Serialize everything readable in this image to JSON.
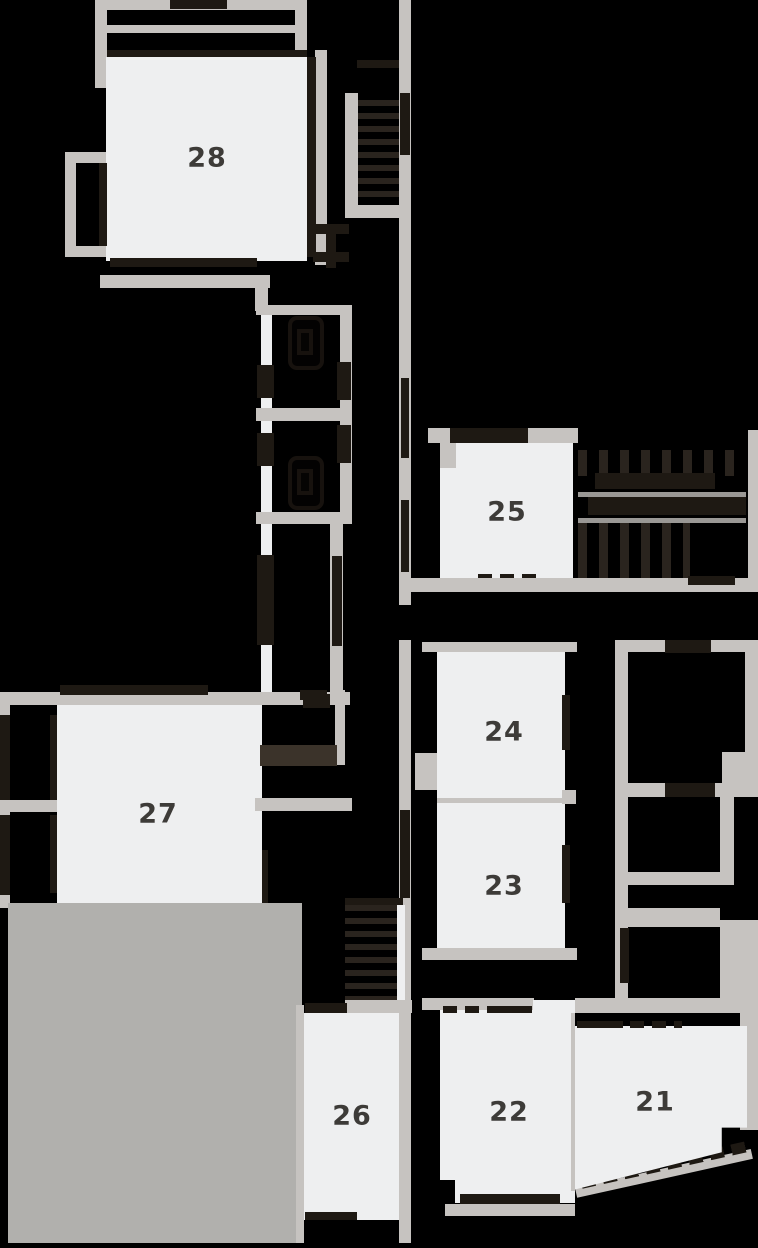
{
  "floor_plan": {
    "units": {
      "u21": {
        "label": "21"
      },
      "u22": {
        "label": "22"
      },
      "u23": {
        "label": "23"
      },
      "u24": {
        "label": "24"
      },
      "u25": {
        "label": "25"
      },
      "u26": {
        "label": "26"
      },
      "u27": {
        "label": "27"
      },
      "u28": {
        "label": "28"
      }
    },
    "colors": {
      "background": "#000000",
      "walls": "#c6c3c0",
      "unit_fill": "#eeeff0",
      "terrace_fill": "#b1b0ad",
      "openings": "#1e1913",
      "label_text": "#3d3b38",
      "stair_treads": "#2a241e"
    }
  }
}
